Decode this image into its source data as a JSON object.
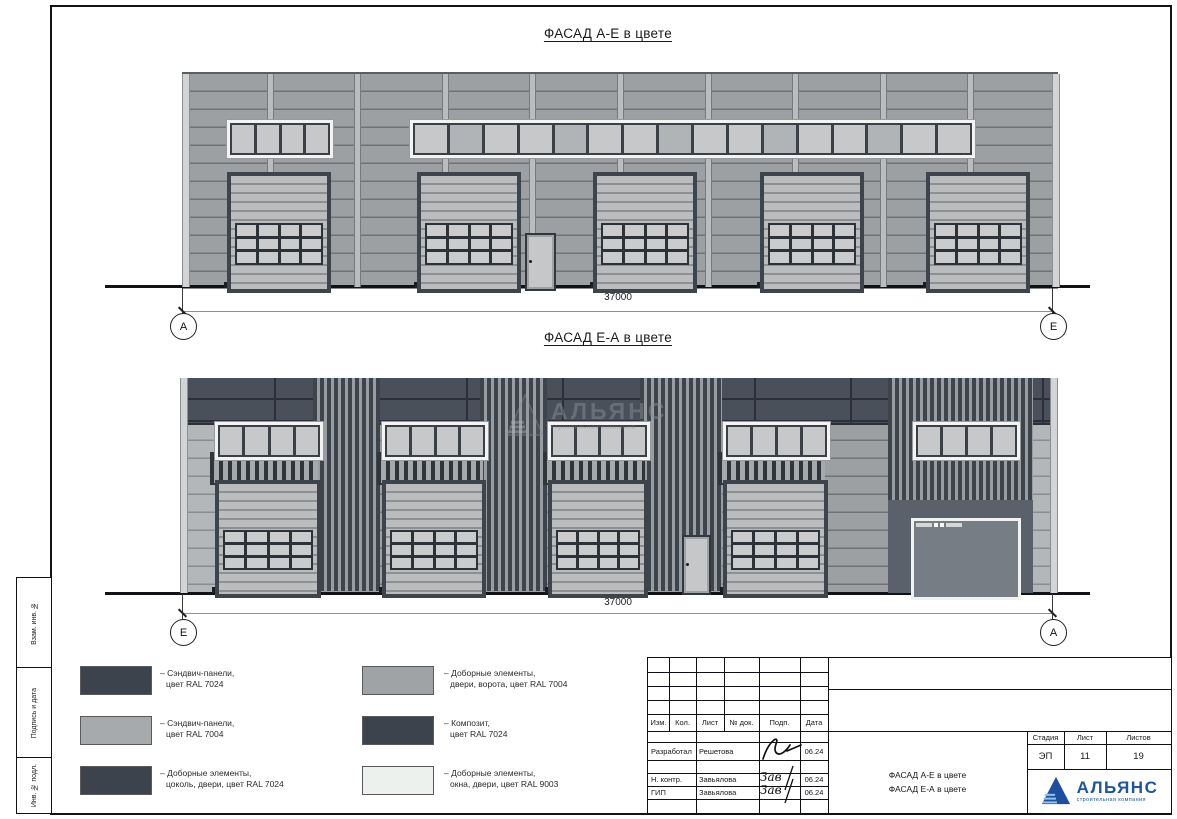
{
  "drawing": {
    "facade_top": {
      "title": "ФАСАД А-Е в цвете",
      "dimension": "37000",
      "axis_left": "А",
      "axis_right": "Е"
    },
    "facade_bottom": {
      "title": "ФАСАД Е-А в цвете",
      "dimension": "37000",
      "axis_left": "Е",
      "axis_right": "А"
    },
    "watermark": {
      "name": "АЛЬЯНС",
      "subtitle": "строительная компания"
    }
  },
  "legend": {
    "items": [
      {
        "line1": "– Сэндвич-панели,",
        "line2": "цвет RAL 7024",
        "color": "#3d434d"
      },
      {
        "line1": "– Сэндвич-панели,",
        "line2": "цвет RAL 7004",
        "color": "#a7aaac"
      },
      {
        "line1": "– Доборные элементы,",
        "line2": "цоколь, двери, цвет RAL 7024",
        "color": "#3d434d"
      },
      {
        "line1": "– Доборные элементы,",
        "line2": "двери, ворота, цвет RAL 7004",
        "color": "#9fa3a6"
      },
      {
        "line1": "– Композит,",
        "line2": "цвет RAL 7024",
        "color": "#3d434d"
      },
      {
        "line1": "– Доборные элементы,",
        "line2": "окна, двери, цвет RAL 9003",
        "color": "#edf1ee"
      }
    ]
  },
  "side_labels": [
    "Взам. инв. №",
    "Подпись и дата",
    "Инв. № подл."
  ],
  "titleblock": {
    "cols": {
      "izm": "Изм.",
      "kol": "Кол.",
      "list": "Лист",
      "ndok": "№ док.",
      "podp": "Подп.",
      "data": "Дата"
    },
    "rows": [
      {
        "role": "Разработал",
        "name": "Решетова",
        "date": "06.24"
      },
      {
        "role": "Н. контр.",
        "name": "Завьялова",
        "date": "06.24"
      },
      {
        "role": "ГИП",
        "name": "Завьялова",
        "date": "06.24"
      }
    ],
    "stage": {
      "h_stage": "Стадия",
      "h_list": "Лист",
      "h_listov": "Листов",
      "stage": "ЭП",
      "list": "11",
      "listov": "19"
    },
    "doc_title_line1": "ФАСАД А-Е в цвете",
    "doc_title_line2": "ФАСАД Е-А в цвете",
    "logo": {
      "name": "АЛЬЯНС",
      "subtitle": "строительная компания"
    }
  },
  "colors": {
    "ral_7024": "#3d434d",
    "ral_7004": "#a7aaac",
    "ral_9003": "#edf1ee",
    "wall_gray": "#9da0a3",
    "dark_band": "#4a505a",
    "logo_blue": "#1d55a0"
  }
}
